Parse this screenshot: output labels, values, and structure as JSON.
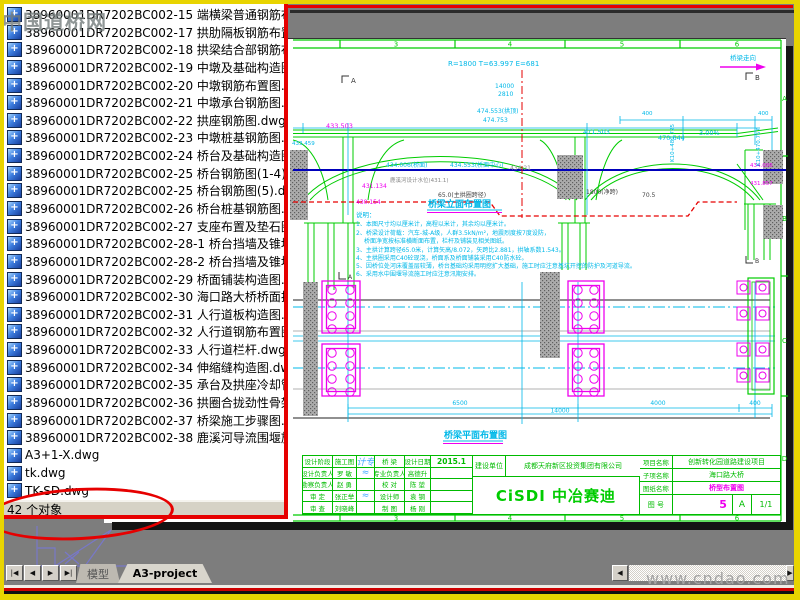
{
  "watermarks": {
    "top_left": "中国道桥网",
    "bottom_right": "www.cndao.com"
  },
  "panel": {
    "status": "42 个对象",
    "files": [
      "38960001DR7202BC002-14  中横梁普通钢筋布置图.",
      "38960001DR7202BC002-15  端横梁普通钢筋布置图.",
      "38960001DR7202BC002-17  拱肋隔板钢筋布置图.dw",
      "38960001DR7202BC002-18  拱梁结合部钢筋布置图.",
      "38960001DR7202BC002-19  中墩及基础构造图.dwg",
      "38960001DR7202BC002-20  中墩钢筋布置图.dwg",
      "38960001DR7202BC002-21  中墩承台钢筋图.dwg",
      "38960001DR7202BC002-22  拱座钢筋图.dwg",
      "38960001DR7202BC002-23  中墩桩基钢筋图.dwg",
      "38960001DR7202BC002-24  桥台及基础构造图.dwg",
      "38960001DR7202BC002-25  桥台钢筋图(1-4).dwg",
      "38960001DR7202BC002-25  桥台钢筋图(5).dwg",
      "38960001DR7202BC002-26  桥台桩基钢筋图.dwg",
      "38960001DR7202BC002-27  支座布置及垫石图.dwg",
      "38960001DR7202BC002-28-1  桥台挡墙及锥坡构造.",
      "38960001DR7202BC002-28-2  桥台挡墙及锥坡构造.",
      "38960001DR7202BC002-29  桥面铺装构造图.dwg",
      "38960001DR7202BC002-30  海口路大桥桥面排水构.",
      "38960001DR7202BC002-31  人行道板构造图.dwg",
      "38960001DR7202BC002-32  人行道钢筋布置图.dwg",
      "38960001DR7202BC002-33  人行道栏杆.dwg",
      "38960001DR7202BC002-34  伸缩缝构造图.dwg",
      "38960001DR7202BC002-35  承台及拱座冷却管.dwg",
      "38960001DR7202BC002-36  拱圈合拢劲性骨架图.dw",
      "38960001DR7202BC002-37  桥梁施工步骤图.dwg",
      "38960001DR7202BC002-38  鹿溪河导流围堰施工示.",
      "A3+1-X.dwg",
      "tk.dwg",
      "TK-SD.dwg"
    ]
  },
  "tabs": {
    "nav": [
      "|◀",
      "◀",
      "▶",
      "▶|"
    ],
    "model": "模型",
    "layout": "A3-project"
  },
  "frame": {
    "c3": "3",
    "c4": "4",
    "c5": "5",
    "c6": "6",
    "rA": "A",
    "rB": "B",
    "rC": "C",
    "rD": "D"
  },
  "el": {
    "title": "桥梁立面布置图",
    "curve": "R=1800 T=63.997 E=681",
    "direction": "桥梁走向",
    "secA": "A",
    "secB": "B",
    "d14000": "14000",
    "d2810": "2810",
    "d400a": "400",
    "d400b": "400",
    "span": "65.0(主拱圈跨径)",
    "clear": "1800(净跨)",
    "d705": "70.5",
    "e433503": "433.503",
    "e471503": "471.503",
    "e474553": "474.553(拱顶)",
    "e474753": "474.753",
    "e470644": "470.644",
    "slope": "3.00%",
    "deck": "434.006(桥面)",
    "deckc": "434.553(桥面中心)",
    "e43421": "434.21",
    "water": "鹿溪河设计水位(431.1)",
    "m431134": "431.134",
    "m430154": "430.154",
    "r434006": "434.006",
    "r431857": "431.857",
    "k1": "K10+480.725",
    "k2": "K10+470.757",
    "l433459": "433.459"
  },
  "notes": {
    "head": "说明：",
    "l1": "1、本图尺寸均以厘米计，高程以米计，其余均以厘米计。",
    "l2": "2、桥梁设计荷载：汽车-城-A级，人群3.5kN/m²，地震烈度按7度设防，",
    "l2b": "桥面净宽按标准横断面布置，栏杆及铺装见相关图纸。",
    "l3": "3、主拱计算跨径65.0米，计算矢高/8.072，矢跨比2.881，拱轴系数1.543。",
    "l4": "4、主拱圈采用C40砼现浇，桥面系及桥面铺装采用C40防水砼。",
    "l5": "5、因桥位处河床覆盖层较薄，桥台基础均采用明挖扩大基础，施工时应注意基坑开挖的防护及河道导流。",
    "l6": "6、采用水中围堰导流施工时应注意汛期安排。"
  },
  "plan": {
    "title": "桥梁平面布置图",
    "secA": "A",
    "secB": "B",
    "d6500": "6500",
    "d4000": "4000",
    "d400": "400",
    "d14000": "14000"
  },
  "tb": {
    "table": [
      [
        "设计阶段",
        "施工图",
        "设计专业",
        "桥  梁",
        "设计日期",
        "2015.1"
      ],
      [
        "设计负责人",
        "罗  敏",
        "≈",
        "专业负责人",
        "高德升",
        ""
      ],
      [
        "勘察负责人",
        "赵  勇",
        "",
        "校  对",
        "陈  堃",
        ""
      ],
      [
        "审  定",
        "张正举",
        "≈",
        "设计师",
        "袁  钢",
        ""
      ],
      [
        "审  查",
        "刘晓峰",
        "",
        "制  图",
        "杨  刚",
        ""
      ]
    ],
    "owner_label": "建设单位",
    "owner": "成都天府新区投资集团有限公司",
    "logo": "CiSDI 中冶赛迪",
    "r1l": "项目名称",
    "r1v": "创新转化园道路建设项目",
    "r2l": "子项名称",
    "r2v": "海口路大桥",
    "r3l": "图纸名称",
    "r3v": "桥型布置图",
    "r4l": "图  号",
    "no": "5",
    "size": "A",
    "page": "1/1"
  }
}
